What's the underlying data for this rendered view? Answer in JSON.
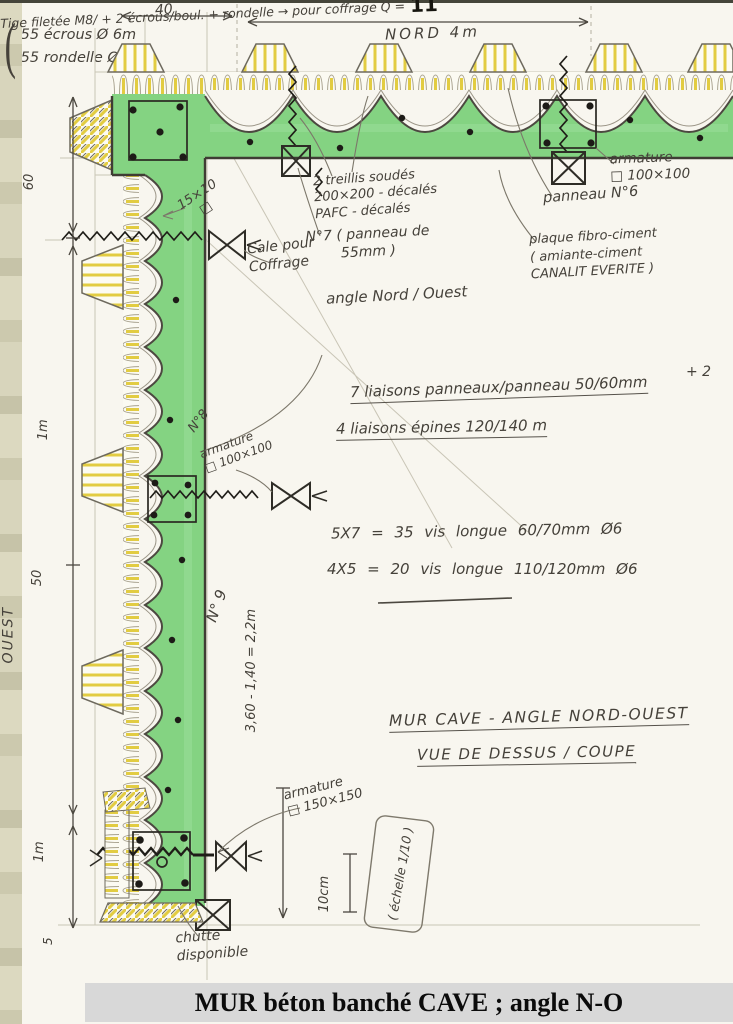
{
  "title": {
    "banner": "MUR béton banché CAVE ; angle N-O"
  },
  "colors": {
    "wall_green": "#84d382",
    "form_yellow": "#e2cc42",
    "pencil": "#b9b4a4",
    "ink": "#45413a",
    "title_bg": "#d8d8d8",
    "paper": "#f8f6ef"
  },
  "dims": {
    "top_40": "40",
    "nord": "NORD 4m",
    "left_60": "60",
    "left_1m": "1m",
    "left_50": "50",
    "ouest": "OUEST",
    "bottom_1m": "1m",
    "bottom_5": "5",
    "corner_note": "15×10\n□",
    "height_calc": "3,60 - 1,40 = 2,2m",
    "ten_cm": "10cm"
  },
  "notes": {
    "cale": "Cale pour\nCoffrage",
    "treillis": "2 treillis soudés\n200×200 - décalés\nPAFC - décalés",
    "n7": "N°7 ( panneau de\n55mm )",
    "angle": "angle Nord / Ouest",
    "armature_100_top": "armature\n□ 100×100",
    "panneau6": "panneau N°6",
    "plaque": "plaque fibro-ciment\n( amiante-ciment\nCANALIT EVERITE )",
    "tige": "Tige filetée M8/ + 2 écrous/boul. + rondelle → pour coffrage Q =",
    "q_value": "11",
    "plus2": "+ 2",
    "liaisons_panneaux": "7 liaisons panneaux/panneau 50/60mm",
    "liaisons_epines": "4 liaisons épines 120/140 m",
    "n8": "N°8",
    "armature_100_mid": "armature\n□ 100×100",
    "n9": "N° 9",
    "armature_150": "armature\n□ 150×150",
    "echelle": "( échelle 1/10 )",
    "chutte": "chutte\ndisponible",
    "paren": "(",
    "ecrous": "55 écrous Ø 6m\n55 rondelle Ø 6m",
    "mur_cave": "MUR CAVE - ANGLE NORD-OUEST",
    "vue": "VUE DE DESSUS / COUPE"
  },
  "calcs": {
    "line1": "5X7 = 35 vis longue 60/70mm Ø6",
    "line2": "4X5 = 20 vis longue 110/120mm Ø6"
  }
}
